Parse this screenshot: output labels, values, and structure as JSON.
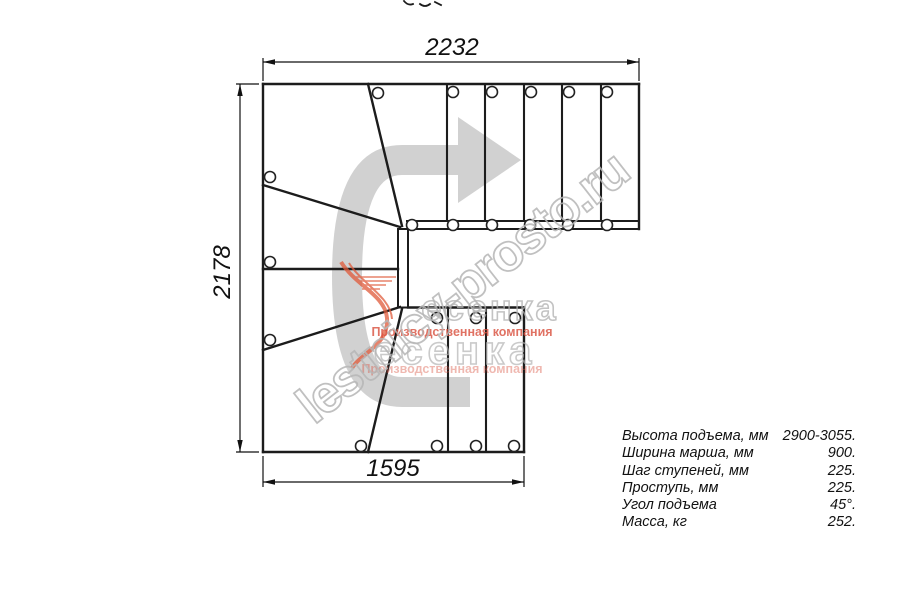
{
  "diagram": {
    "type": "staircase-plan-top-view",
    "dimensions": {
      "top_width_mm": "2232",
      "left_height_mm": "2178",
      "bottom_width_mm": "1595"
    },
    "watermark": {
      "site": "lestnicy-prosto.ru",
      "logo_text_row1": "есенка",
      "logo_text_row2": "есенка",
      "logo_subtitle": "Производственная компания"
    },
    "specs": {
      "rows": [
        {
          "label": "Высота подъема, мм",
          "value": "2900-3055."
        },
        {
          "label": "Ширина марша, мм",
          "value": "900."
        },
        {
          "label": "Шаг ступеней, мм",
          "value": "225."
        },
        {
          "label": "Проступь, мм",
          "value": "225."
        },
        {
          "label": "Угол подъема",
          "value": "45°."
        },
        {
          "label": "Масса, кг",
          "value": "252."
        }
      ]
    },
    "colors": {
      "line": "#1c1c1c",
      "arrow_gray": "#cfcfcf",
      "watermark_gray": "#b6b6b6",
      "accent_red": "#d94f3d",
      "swoosh_orange": "#e05a3a"
    }
  }
}
